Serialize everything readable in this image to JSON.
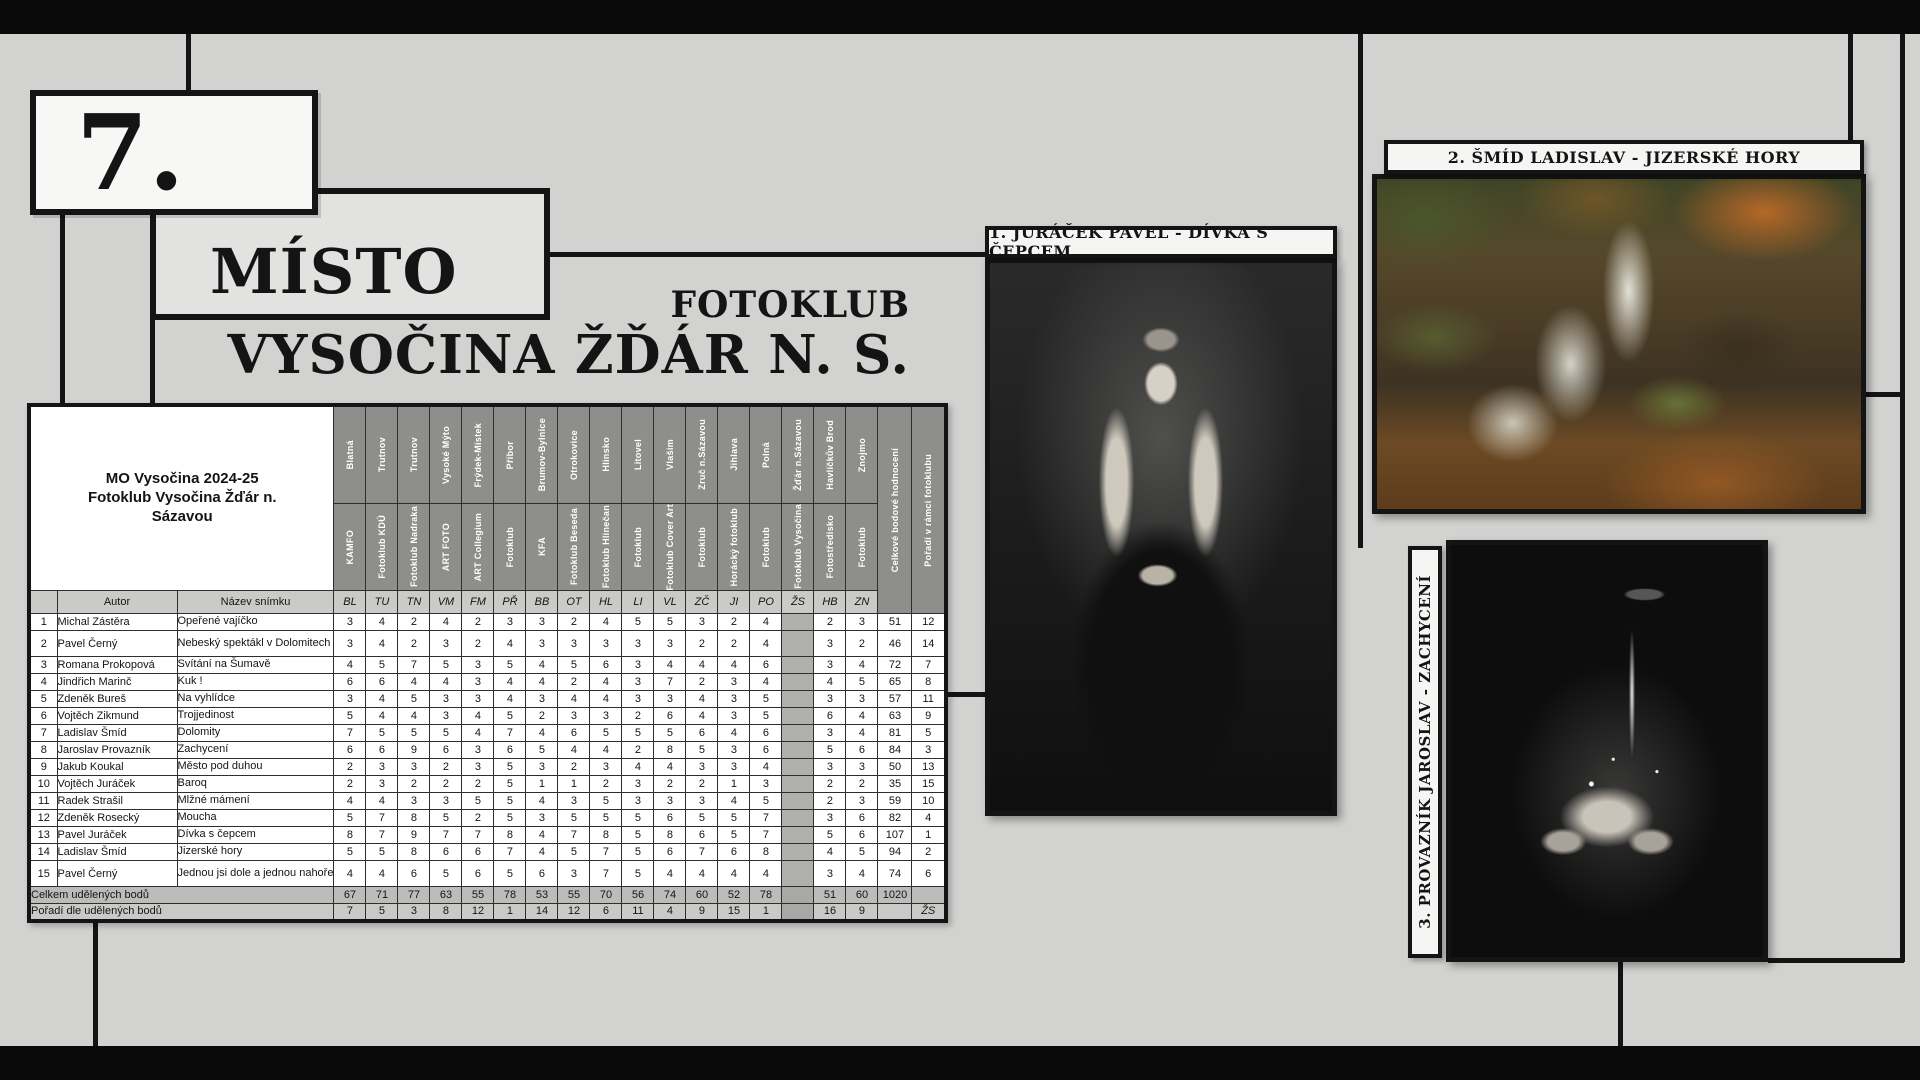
{
  "badge": {
    "rank": "7.",
    "place": "MÍSTO"
  },
  "heading": {
    "line1": "FOTOKLUB",
    "line2": "VYSOČINA ŽĎÁR N. S."
  },
  "table": {
    "title_line1": "MO Vysočina 2024-25",
    "title_line2": "Fotoklub Vysočina Žďár n. Sázavou",
    "col_author": "Autor",
    "col_photo": "Název snímku",
    "col_total": "Celkové bodové hodnocení",
    "col_rank": "Pořadí v rámci fotoklubu",
    "columns": [
      {
        "city": "Blatná",
        "club": "KAMFO",
        "abbr": "BL"
      },
      {
        "city": "Trutnov",
        "club": "Fotoklub KDÚ",
        "abbr": "TU"
      },
      {
        "city": "Trutnov",
        "club": "Fotoklub Nadraka",
        "abbr": "TN"
      },
      {
        "city": "Vysoké Mýto",
        "club": "ART FOTO",
        "abbr": "VM"
      },
      {
        "city": "Frýdek-Místek",
        "club": "ART Collegium",
        "abbr": "FM"
      },
      {
        "city": "Příbor",
        "club": "Fotoklub",
        "abbr": "PŘ"
      },
      {
        "city": "Brumov-Bylnice",
        "club": "KFA",
        "abbr": "BB"
      },
      {
        "city": "Otrokovice",
        "club": "Fotoklub Beseda",
        "abbr": "OT"
      },
      {
        "city": "Hlinsko",
        "club": "Fotoklub Hlinečan",
        "abbr": "HL"
      },
      {
        "city": "Litovel",
        "club": "Fotoklub",
        "abbr": "LI"
      },
      {
        "city": "Vlašim",
        "club": "Fotoklub Cover Art",
        "abbr": "VL"
      },
      {
        "city": "Zruč n.Sázavou",
        "club": "Fotoklub",
        "abbr": "ZČ"
      },
      {
        "city": "Jihlava",
        "club": "Horácký fotoklub",
        "abbr": "JI"
      },
      {
        "city": "Polná",
        "club": "Fotoklub",
        "abbr": "PO"
      },
      {
        "city": "Žďár n.Sázavou",
        "club": "Fotoklub Vysočina",
        "abbr": "ŽS",
        "home": true
      },
      {
        "city": "Havlíčkův Brod",
        "club": "Fotostředisko",
        "abbr": "HB"
      },
      {
        "city": "Znojmo",
        "club": "Fotoklub",
        "abbr": "ZN"
      }
    ],
    "rows": [
      {
        "n": 1,
        "author": "Michal Zástěra",
        "photo": "Opeřené vajíčko",
        "scores": [
          3,
          4,
          2,
          4,
          2,
          3,
          3,
          2,
          4,
          5,
          5,
          3,
          2,
          4,
          null,
          2,
          3
        ],
        "total": 51,
        "rank": 12
      },
      {
        "n": 2,
        "author": "Pavel Černý",
        "photo": "Nebeský spektákl v Dolomitech",
        "scores": [
          3,
          4,
          2,
          3,
          2,
          4,
          3,
          3,
          3,
          3,
          3,
          2,
          2,
          4,
          null,
          3,
          2
        ],
        "total": 46,
        "rank": 14
      },
      {
        "n": 3,
        "author": "Romana Prokopová",
        "photo": "Svítání na Šumavě",
        "scores": [
          4,
          5,
          7,
          5,
          3,
          5,
          4,
          5,
          6,
          3,
          4,
          4,
          4,
          6,
          null,
          3,
          4
        ],
        "total": 72,
        "rank": 7
      },
      {
        "n": 4,
        "author": "Jindřich Marinč",
        "photo": "Kuk !",
        "scores": [
          6,
          6,
          4,
          4,
          3,
          4,
          4,
          2,
          4,
          3,
          7,
          2,
          3,
          4,
          null,
          4,
          5
        ],
        "total": 65,
        "rank": 8
      },
      {
        "n": 5,
        "author": "Zdeněk Bureš",
        "photo": "Na vyhlídce",
        "scores": [
          3,
          4,
          5,
          3,
          3,
          4,
          3,
          4,
          4,
          3,
          3,
          4,
          3,
          5,
          null,
          3,
          3
        ],
        "total": 57,
        "rank": 11
      },
      {
        "n": 6,
        "author": "Vojtěch Zikmund",
        "photo": "Trojjedinost",
        "scores": [
          5,
          4,
          4,
          3,
          4,
          5,
          2,
          3,
          3,
          2,
          6,
          4,
          3,
          5,
          null,
          6,
          4
        ],
        "total": 63,
        "rank": 9
      },
      {
        "n": 7,
        "author": "Ladislav Šmíd",
        "photo": "Dolomity",
        "scores": [
          7,
          5,
          5,
          5,
          4,
          7,
          4,
          6,
          5,
          5,
          5,
          6,
          4,
          6,
          null,
          3,
          4
        ],
        "total": 81,
        "rank": 5
      },
      {
        "n": 8,
        "author": "Jaroslav Provazník",
        "photo": "Zachycení",
        "scores": [
          6,
          6,
          9,
          6,
          3,
          6,
          5,
          4,
          4,
          2,
          8,
          5,
          3,
          6,
          null,
          5,
          6
        ],
        "total": 84,
        "rank": 3
      },
      {
        "n": 9,
        "author": "Jakub Koukal",
        "photo": "Město pod duhou",
        "scores": [
          2,
          3,
          3,
          2,
          3,
          5,
          3,
          2,
          3,
          4,
          4,
          3,
          3,
          4,
          null,
          3,
          3
        ],
        "total": 50,
        "rank": 13
      },
      {
        "n": 10,
        "author": "Vojtěch Juráček",
        "photo": "Baroq",
        "scores": [
          2,
          3,
          2,
          2,
          2,
          5,
          1,
          1,
          2,
          3,
          2,
          2,
          1,
          3,
          null,
          2,
          2
        ],
        "total": 35,
        "rank": 15
      },
      {
        "n": 11,
        "author": "Radek Strašil",
        "photo": "Mlžné mámení",
        "scores": [
          4,
          4,
          3,
          3,
          5,
          5,
          4,
          3,
          5,
          3,
          3,
          3,
          4,
          5,
          null,
          2,
          3
        ],
        "total": 59,
        "rank": 10
      },
      {
        "n": 12,
        "author": "Zdeněk Rosecký",
        "photo": "Moucha",
        "scores": [
          5,
          7,
          8,
          5,
          2,
          5,
          3,
          5,
          5,
          5,
          6,
          5,
          5,
          7,
          null,
          3,
          6
        ],
        "total": 82,
        "rank": 4
      },
      {
        "n": 13,
        "author": "Pavel Juráček",
        "photo": "Dívka s čepcem",
        "scores": [
          8,
          7,
          9,
          7,
          7,
          8,
          4,
          7,
          8,
          5,
          8,
          6,
          5,
          7,
          null,
          5,
          6
        ],
        "total": 107,
        "rank": 1
      },
      {
        "n": 14,
        "author": "Ladislav Šmíd",
        "photo": "Jizerské hory",
        "scores": [
          5,
          5,
          8,
          6,
          6,
          7,
          4,
          5,
          7,
          5,
          6,
          7,
          6,
          8,
          null,
          4,
          5
        ],
        "total": 94,
        "rank": 2
      },
      {
        "n": 15,
        "author": "Pavel Černý",
        "photo": "Jednou jsi dole a jednou nahoře",
        "scores": [
          4,
          4,
          6,
          5,
          6,
          5,
          6,
          3,
          7,
          5,
          4,
          4,
          4,
          4,
          null,
          3,
          4
        ],
        "total": 74,
        "rank": 6
      }
    ],
    "totals_row": {
      "label": "Celkem udělených bodů",
      "values": [
        67,
        71,
        77,
        63,
        55,
        78,
        53,
        55,
        70,
        56,
        74,
        60,
        52,
        78,
        null,
        51,
        60
      ],
      "total": 1020,
      "rank": ""
    },
    "ranks_row": {
      "label": "Pořadí dle udělených bodů",
      "values": [
        7,
        5,
        3,
        8,
        12,
        1,
        14,
        12,
        6,
        11,
        4,
        9,
        15,
        1,
        null,
        16,
        9
      ],
      "total": "",
      "rank": "ŽS"
    }
  },
  "photos": [
    {
      "title": "1. JURÁČEK PAVEL - DÍVKA S ČEPCEM"
    },
    {
      "title": "2. ŠMÍD LADISLAV - JIZERSKÉ HORY"
    },
    {
      "title": "3. PROVAZNÍK JAROSLAV - ZACHYCENÍ"
    }
  ],
  "colors": {
    "background": "#d2d2d0",
    "bars": "#0a0a0a",
    "header_cell": "#8e8e8c",
    "abbr_row": "#cacac8",
    "home_cell": "#b0b0ae"
  }
}
